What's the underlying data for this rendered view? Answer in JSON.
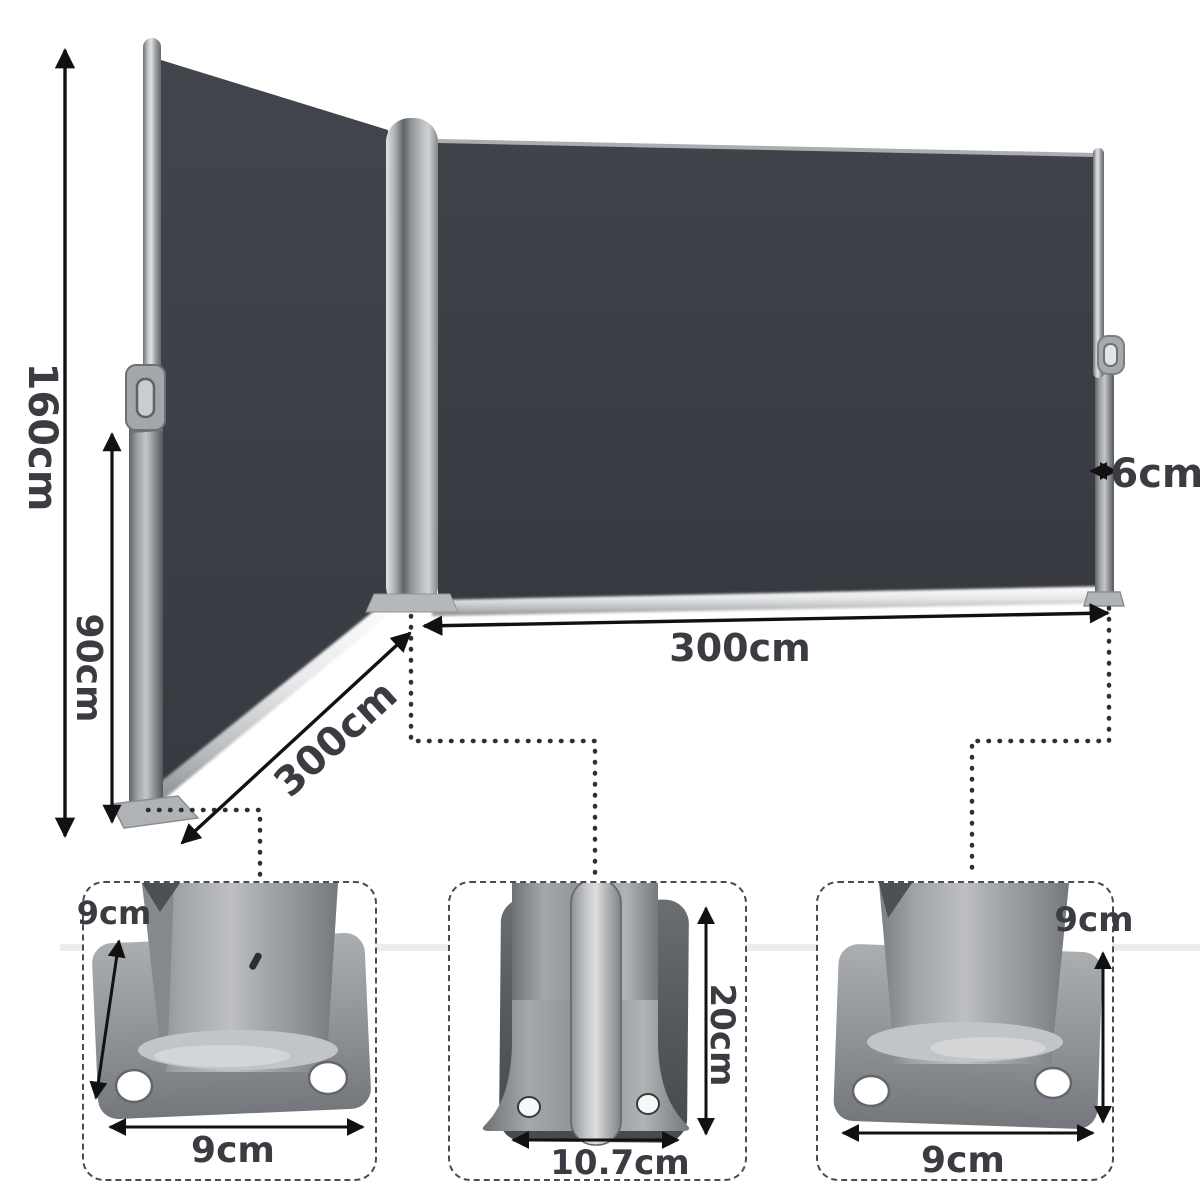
{
  "diagram_type": "retractable-double-side-awning-dimension-diagram",
  "dim_labels": {
    "overall_height": "160cm",
    "post_height": "90cm",
    "left_panel_length": "300cm",
    "right_panel_length": "300cm",
    "post_width": "6cm"
  },
  "insets": {
    "left": {
      "side": "9cm",
      "width": "9cm"
    },
    "center": {
      "height": "20cm",
      "width": "10.7cm"
    },
    "right": {
      "side": "9cm",
      "width": "9cm"
    }
  },
  "colors": {
    "fabric": "#3d3f46",
    "metal": "#9a9da1",
    "text": "#3a3c42",
    "arrow": "#111111",
    "dots": "#2f2f2f",
    "dash_border": "#4c4c4c"
  }
}
